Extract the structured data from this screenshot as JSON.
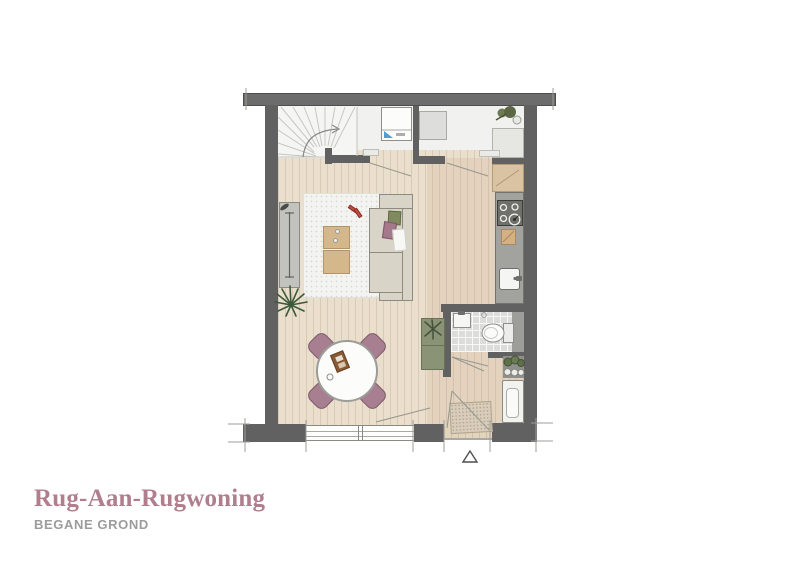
{
  "title": {
    "text": "Rug-Aan-Rugwoning"
  },
  "subtitle": {
    "text": "BEGANE GROND"
  },
  "plan": {
    "colors": {
      "wall": "#616161",
      "wall-band": "#6c6c6c",
      "floor-wood": "#eadfcd",
      "floor-pale": "#f1f1ef",
      "tile": "#dcdcda",
      "counter": "#a2a29e",
      "cooktop": "#6f6f6b",
      "tan": "#d9c3a3",
      "wood": "#d5b78c",
      "mauve": "#a87f90",
      "mauve-dark": "#7c5a6b",
      "greige": "#d8d4c8",
      "greige-outline": "#8f8a7e",
      "green": "#8b9377",
      "green-dark": "#44523a",
      "plant-dark": "#3c5a3a",
      "rug": "#f3f3f1",
      "white-item": "#f6f6f4",
      "line": "#9a9a94",
      "title-color": "#b17e8e",
      "subtitle-color": "#9c9c9c",
      "accent-blue": "#4f9fd4",
      "accent-red": "#c14b42"
    },
    "entrance_marker": "△",
    "furniture": [
      "staircase",
      "washing-machine",
      "boiler-unit",
      "refrigerator",
      "plant",
      "kitchen-upper-cabinet",
      "cooktop",
      "cutting-board",
      "kitchen-sink",
      "kitchen-counter",
      "radiator",
      "area-rug",
      "coffee-table",
      "sofa",
      "cushions",
      "dining-table",
      "dining-chair",
      "serving-tray",
      "storage-cabinet",
      "wash-basin",
      "toilet",
      "hall-shelf-plants",
      "hall-radiator",
      "doormat",
      "window",
      "front-door",
      "stair-direction-arrow",
      "entrance-marker"
    ]
  }
}
